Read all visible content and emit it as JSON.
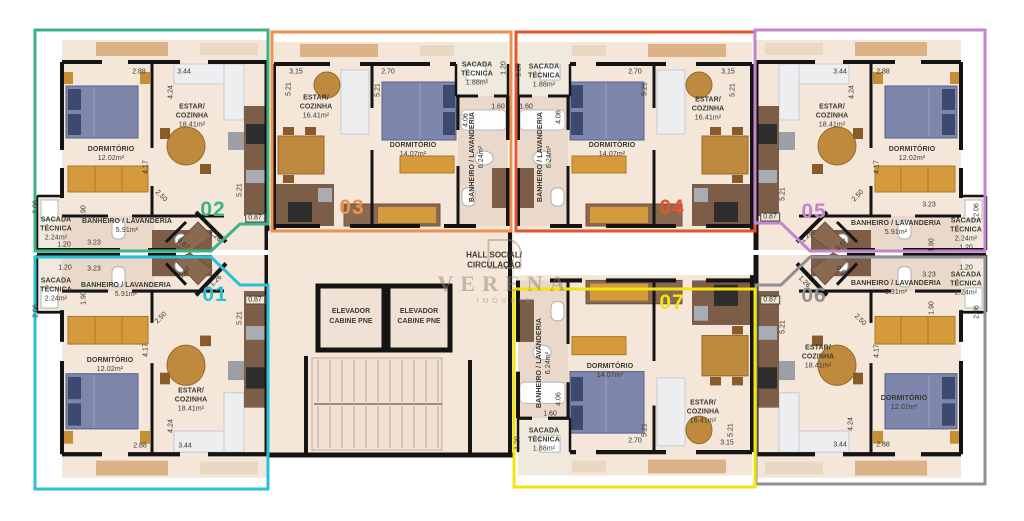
{
  "plan": {
    "hall_label": "HALL SOCIAL/\nCIRCULAÇÃO",
    "elevator_label": "ELEVADOR\nCABINE PNE",
    "watermark": {
      "name": "VERENA",
      "sub": "IMÓVEIS"
    },
    "wall_color": "#141414",
    "floor_color": "#f4e6d8"
  },
  "units": [
    {
      "number": "01",
      "color": "#29c0d6",
      "rooms": {
        "dormitorio": {
          "name": "DORMITÓRIO",
          "area": "12.02m²"
        },
        "estar": {
          "name": "ESTAR/\nCOZINHA",
          "area": "18.41m²"
        },
        "banheiro": {
          "name": "BANHEIRO / LAVANDERIA",
          "area": "5.91m²"
        },
        "sacada": {
          "name": "SACADA\nTÉCNICA",
          "area": "2.24m²"
        }
      },
      "dims": [
        "1.20",
        "3.23",
        "2.06",
        "1.90",
        "2.50",
        "4.17",
        "5.21",
        "0.87",
        "1.26",
        "0.67",
        "2.88",
        "3.44",
        "4.24"
      ]
    },
    {
      "number": "02",
      "color": "#3db383",
      "rooms": {
        "dormitorio": {
          "name": "DORMITÓRIO",
          "area": "12.02m²"
        },
        "estar": {
          "name": "ESTAR/\nCOZINHA",
          "area": "18.41m²"
        },
        "banheiro": {
          "name": "BANHEIRO / LAVANDERIA",
          "area": "5.91m²"
        },
        "sacada": {
          "name": "SACADA\nTÉCNICA",
          "area": "2.24m²"
        }
      },
      "dims": [
        "2.88",
        "3.44",
        "4.24",
        "4.17",
        "2.50",
        "1.90",
        "5.21",
        "0.87",
        "1.26",
        "0.67",
        "2.06",
        "1.20",
        "3.23"
      ]
    },
    {
      "number": "03",
      "color": "#f0904e",
      "rooms": {
        "dormitorio": {
          "name": "DORMITÓRIO",
          "area": "14.07m²"
        },
        "estar": {
          "name": "ESTAR/\nCOZINHA",
          "area": "16.41m²"
        },
        "banheiro": {
          "name": "BANHEIRO / LAVANDERIA",
          "area": "6.24m²"
        },
        "sacada": {
          "name": "SACADA\nTÉCNICA",
          "area": "1.88m²"
        }
      },
      "dims": [
        "3.15",
        "5.21",
        "2.70",
        "5.21",
        "1.20",
        "1.60",
        "4.06"
      ]
    },
    {
      "number": "04",
      "color": "#e7532c",
      "rooms": {
        "dormitorio": {
          "name": "DORMITÓRIO",
          "area": "14.07m²"
        },
        "estar": {
          "name": "ESTAR/\nCOZINHA",
          "area": "16.41m²"
        },
        "banheiro": {
          "name": "BANHEIRO / LAVANDERIA",
          "area": "6.24m²"
        },
        "sacada": {
          "name": "SACADA\nTÉCNICA",
          "area": "1.88m²"
        }
      },
      "dims": [
        "1.20",
        "1.60",
        "4.06",
        "2.70",
        "5.21",
        "3.15",
        "5.21"
      ]
    },
    {
      "number": "05",
      "color": "#c584ce",
      "rooms": {
        "dormitorio": {
          "name": "DORMITÓRIO",
          "area": "12.02m²"
        },
        "estar": {
          "name": "ESTAR/\nCOZINHA",
          "area": "18.41m²"
        },
        "banheiro": {
          "name": "BANHEIRO / LAVANDERIA",
          "area": "5.91m²"
        },
        "sacada": {
          "name": "SACADA\nTÉCNICA",
          "area": "2.24m²"
        }
      },
      "dims": [
        "3.44",
        "2.88",
        "4.24",
        "4.17",
        "2.50",
        "5.21",
        "0.87",
        "1.26",
        "0.67",
        "3.23",
        "1.90",
        "2.06",
        "1.20"
      ]
    },
    {
      "number": "06",
      "color": "#909090",
      "rooms": {
        "dormitorio": {
          "name": "DORMITÓRIO",
          "area": "12.02m²"
        },
        "estar": {
          "name": "ESTAR/\nCOZINHA",
          "area": "18.41m²"
        },
        "banheiro": {
          "name": "BANHEIRO / LAVANDERIA",
          "area": "5.91m²"
        },
        "sacada": {
          "name": "SACADA\nTÉCNICA",
          "area": "2.24m²"
        }
      },
      "dims": [
        "0.87",
        "1.26",
        "0.67",
        "5.21",
        "3.23",
        "1.20",
        "1.90",
        "2.06",
        "2.50",
        "4.17",
        "3.44",
        "2.88",
        "4.24"
      ]
    },
    {
      "number": "07",
      "color": "#f5e40b",
      "rooms": {
        "dormitorio": {
          "name": "DORMITÓRIO",
          "area": "14.07m²"
        },
        "estar": {
          "name": "ESTAR/\nCOZINHA",
          "area": "16.41m²"
        },
        "banheiro": {
          "name": "BANHEIRO / LAVANDERIA",
          "area": "6.24m²"
        },
        "sacada": {
          "name": "SACADA\nTÉCNICA",
          "area": "1.88m²"
        }
      },
      "dims": [
        "4.06",
        "1.60",
        "1.20",
        "2.70",
        "5.21",
        "3.15",
        "5.21"
      ]
    }
  ]
}
